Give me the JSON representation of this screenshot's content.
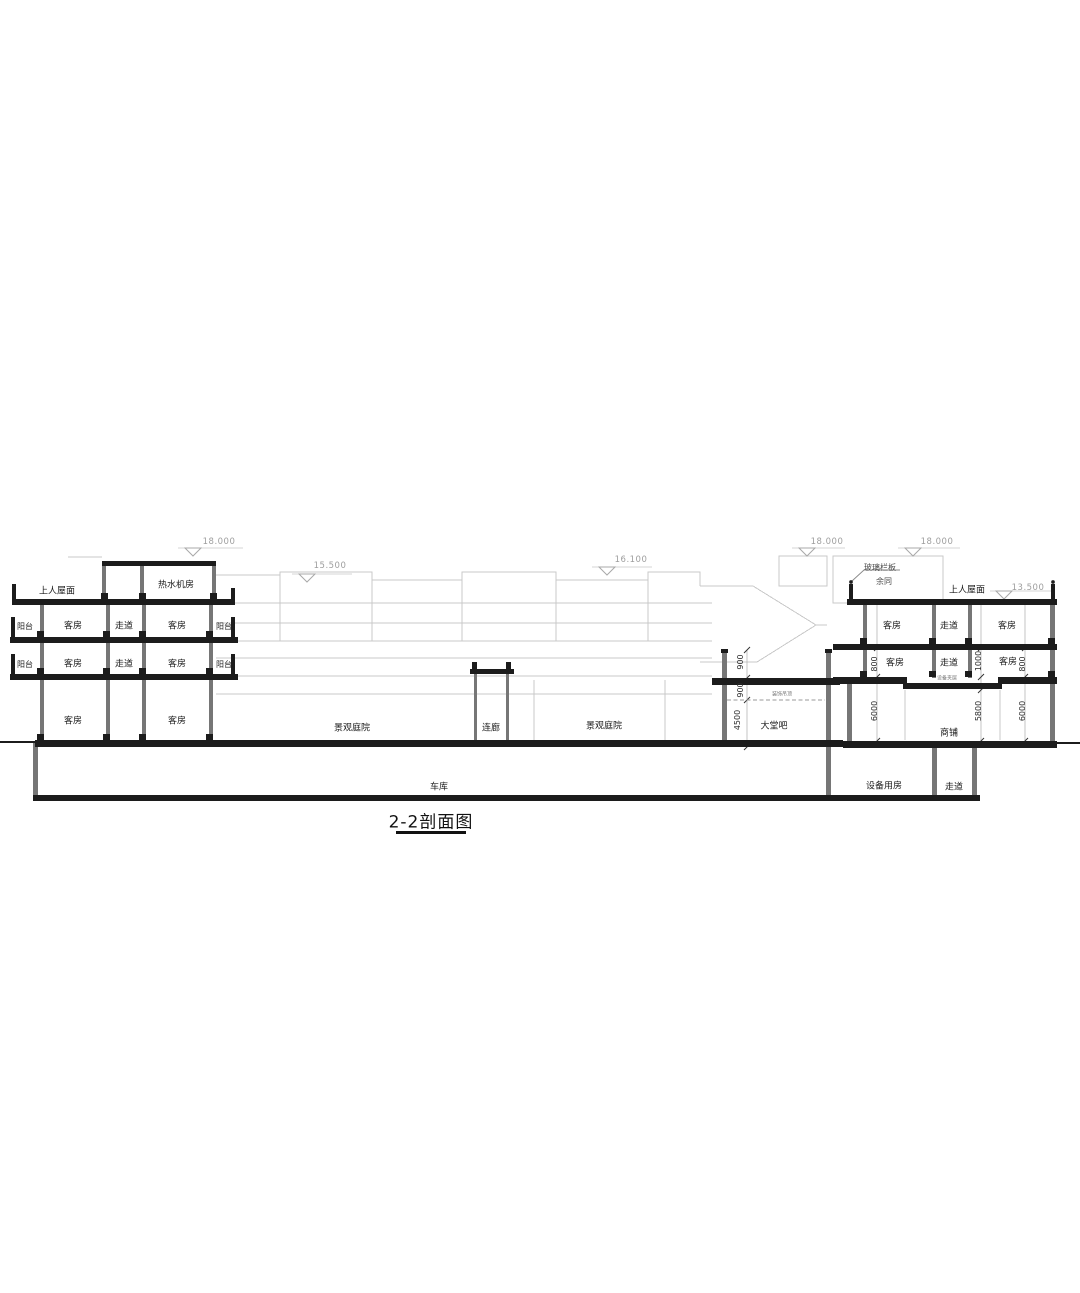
{
  "drawing": {
    "title": "2-2剖面图",
    "left_building": {
      "roof_label": "上人屋面",
      "penthouse": "热水机房",
      "f3": {
        "balcony_l": "阳台",
        "room_l": "客房",
        "corridor": "走道",
        "room_r": "客房",
        "balcony_r": "阳台"
      },
      "f2": {
        "balcony_l": "阳台",
        "room_l": "客房",
        "corridor": "走道",
        "room_r": "客房",
        "balcony_r": "阳台"
      },
      "f1": {
        "room_l": "客房",
        "room_r": "客房"
      }
    },
    "courtyard": {
      "left": "景观庭院",
      "link": "连廊",
      "right": "景观庭院"
    },
    "garage": "车库",
    "lobby": {
      "name": "大堂吧",
      "ceiling_note": "装饰吊顶",
      "dims": [
        "900",
        "900",
        "4500"
      ]
    },
    "right_building": {
      "rail_note": "玻璃栏板",
      "rail_note2": "余同",
      "roof_label": "上人屋面",
      "f2": {
        "room_l": "客房",
        "corridor": "走道",
        "room_r": "客房"
      },
      "f1": {
        "room_l": "客房",
        "corridor": "走道",
        "room_r": "客房",
        "dims": [
          "800",
          "1000",
          "800"
        ]
      },
      "mezz_note": "设备夹层",
      "shop": {
        "name": "商铺",
        "dims": [
          "6000",
          "5800",
          "6000"
        ]
      },
      "basement": {
        "room": "设备用房",
        "corridor": "走道"
      }
    },
    "elevations": {
      "left_top": "18.000",
      "courtyard_1": "15.500",
      "courtyard_2": "16.100",
      "mid_top": "18.000",
      "right_top": "18.000",
      "right_roof": "13.500"
    }
  }
}
